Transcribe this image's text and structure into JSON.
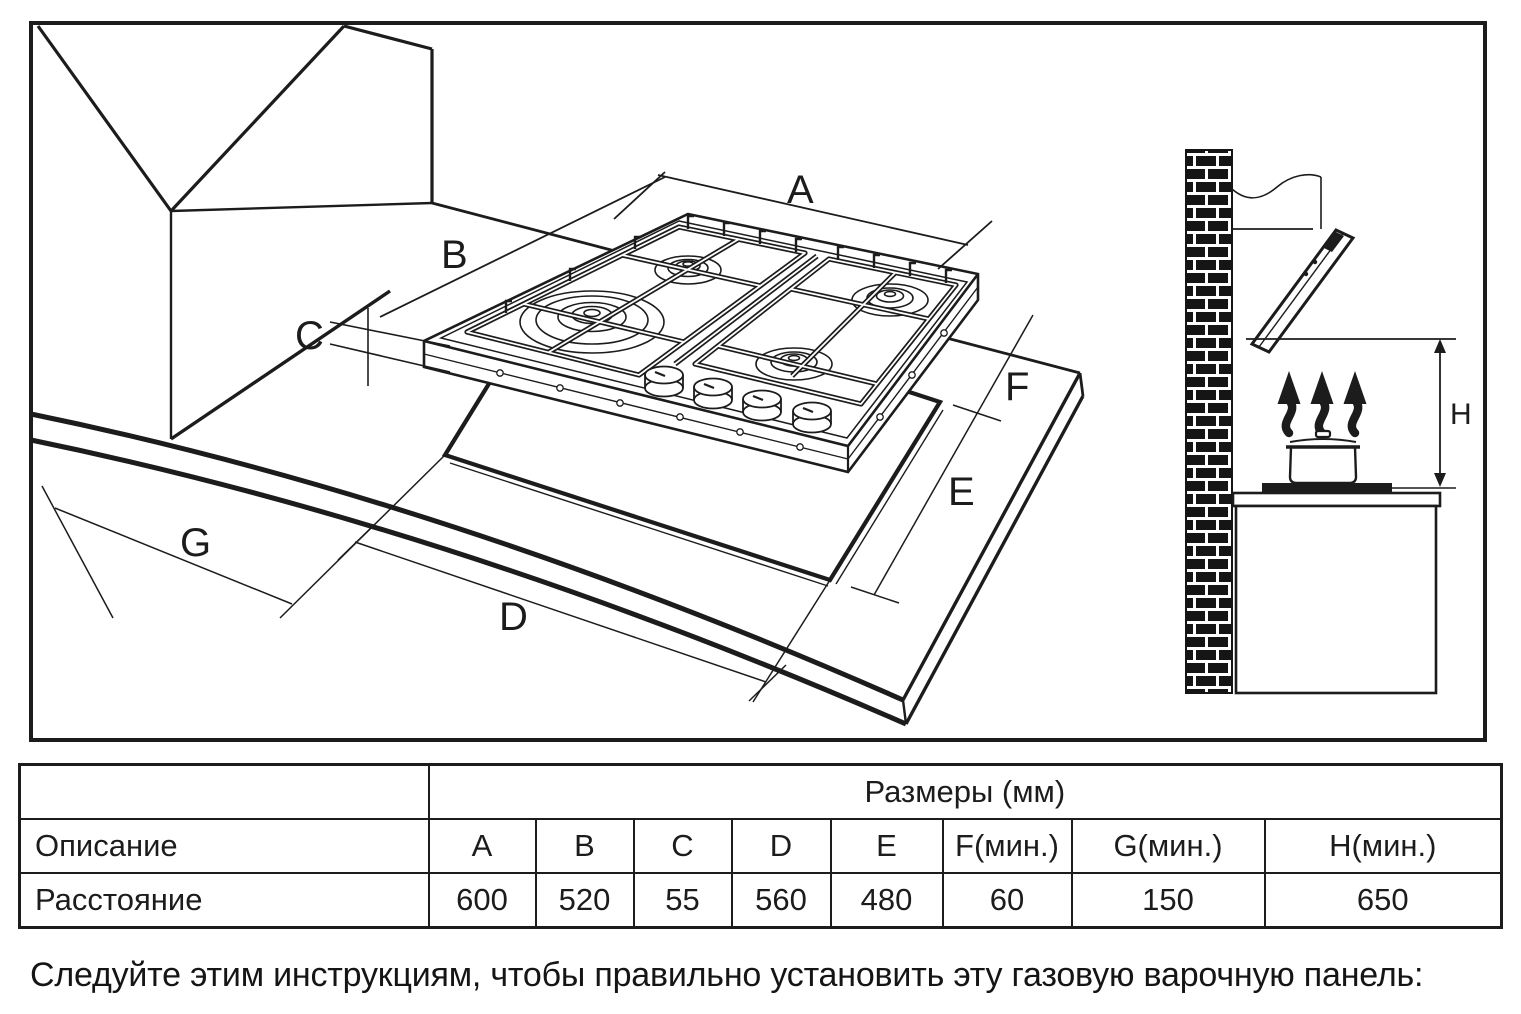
{
  "diagram": {
    "labels": {
      "a": "A",
      "b": "B",
      "c": "C",
      "d": "D",
      "e": "E",
      "f": "F",
      "g": "G",
      "h": "H"
    }
  },
  "table": {
    "header": "Размеры (мм)",
    "row1_label": "Описание",
    "row2_label": "Расстояние",
    "col_headers": [
      "A",
      "B",
      "C",
      "D",
      "E",
      "F(мин.)",
      "G(мин.)",
      "H(мин.)"
    ],
    "values": [
      "600",
      "520",
      "55",
      "560",
      "480",
      "60",
      "150",
      "650"
    ]
  },
  "instruction": "Следуйте этим инструкциям, чтобы правильно установить эту газовую варочную панель:"
}
